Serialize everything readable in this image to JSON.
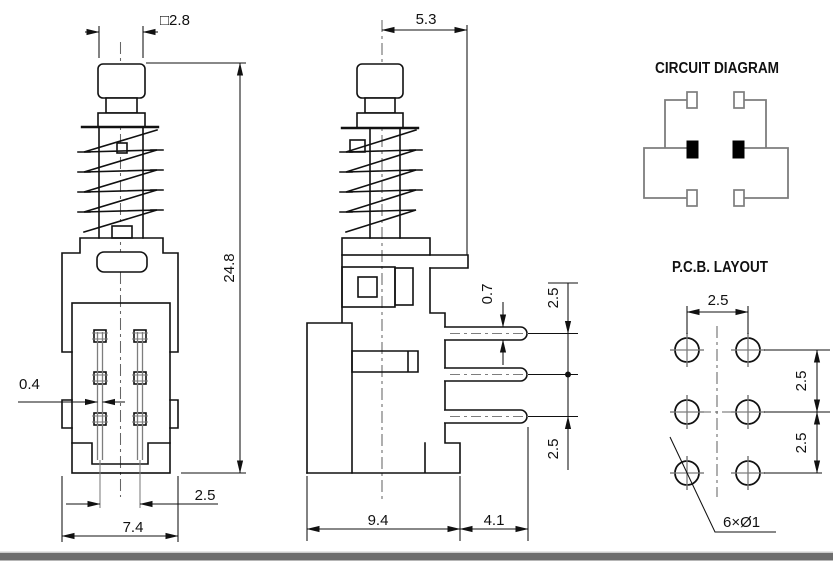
{
  "front_view": {
    "dim_cap_width": "□2.8",
    "dim_height": "24.8",
    "dim_pin_width": "0.4",
    "dim_pin_pitch": "2.5",
    "dim_body_width": "7.4"
  },
  "side_view": {
    "dim_plunger_offset": "5.3",
    "dim_pin_thickness": "0.7",
    "dim_pin_pitch_upper": "2.5",
    "dim_pin_pitch_lower": "2.5",
    "dim_body_depth": "9.4",
    "dim_pin_length": "4.1"
  },
  "circuit_diagram": {
    "title": "CIRCUIT DIAGRAM"
  },
  "pcb_layout": {
    "title": "P.C.B. LAYOUT",
    "dim_hole_pitch_x": "2.5",
    "dim_hole_pitch_y_upper": "2.5",
    "dim_hole_pitch_y_lower": "2.5",
    "hole_note": "6×Ø1"
  },
  "colors": {
    "line": "#111111",
    "auxiliary": "#7d7d7d",
    "footer_bar": "#6d6d6d",
    "footer_bar_edge": "#cccccc",
    "terminal_fill": "#000000",
    "background": "#ffffff"
  }
}
